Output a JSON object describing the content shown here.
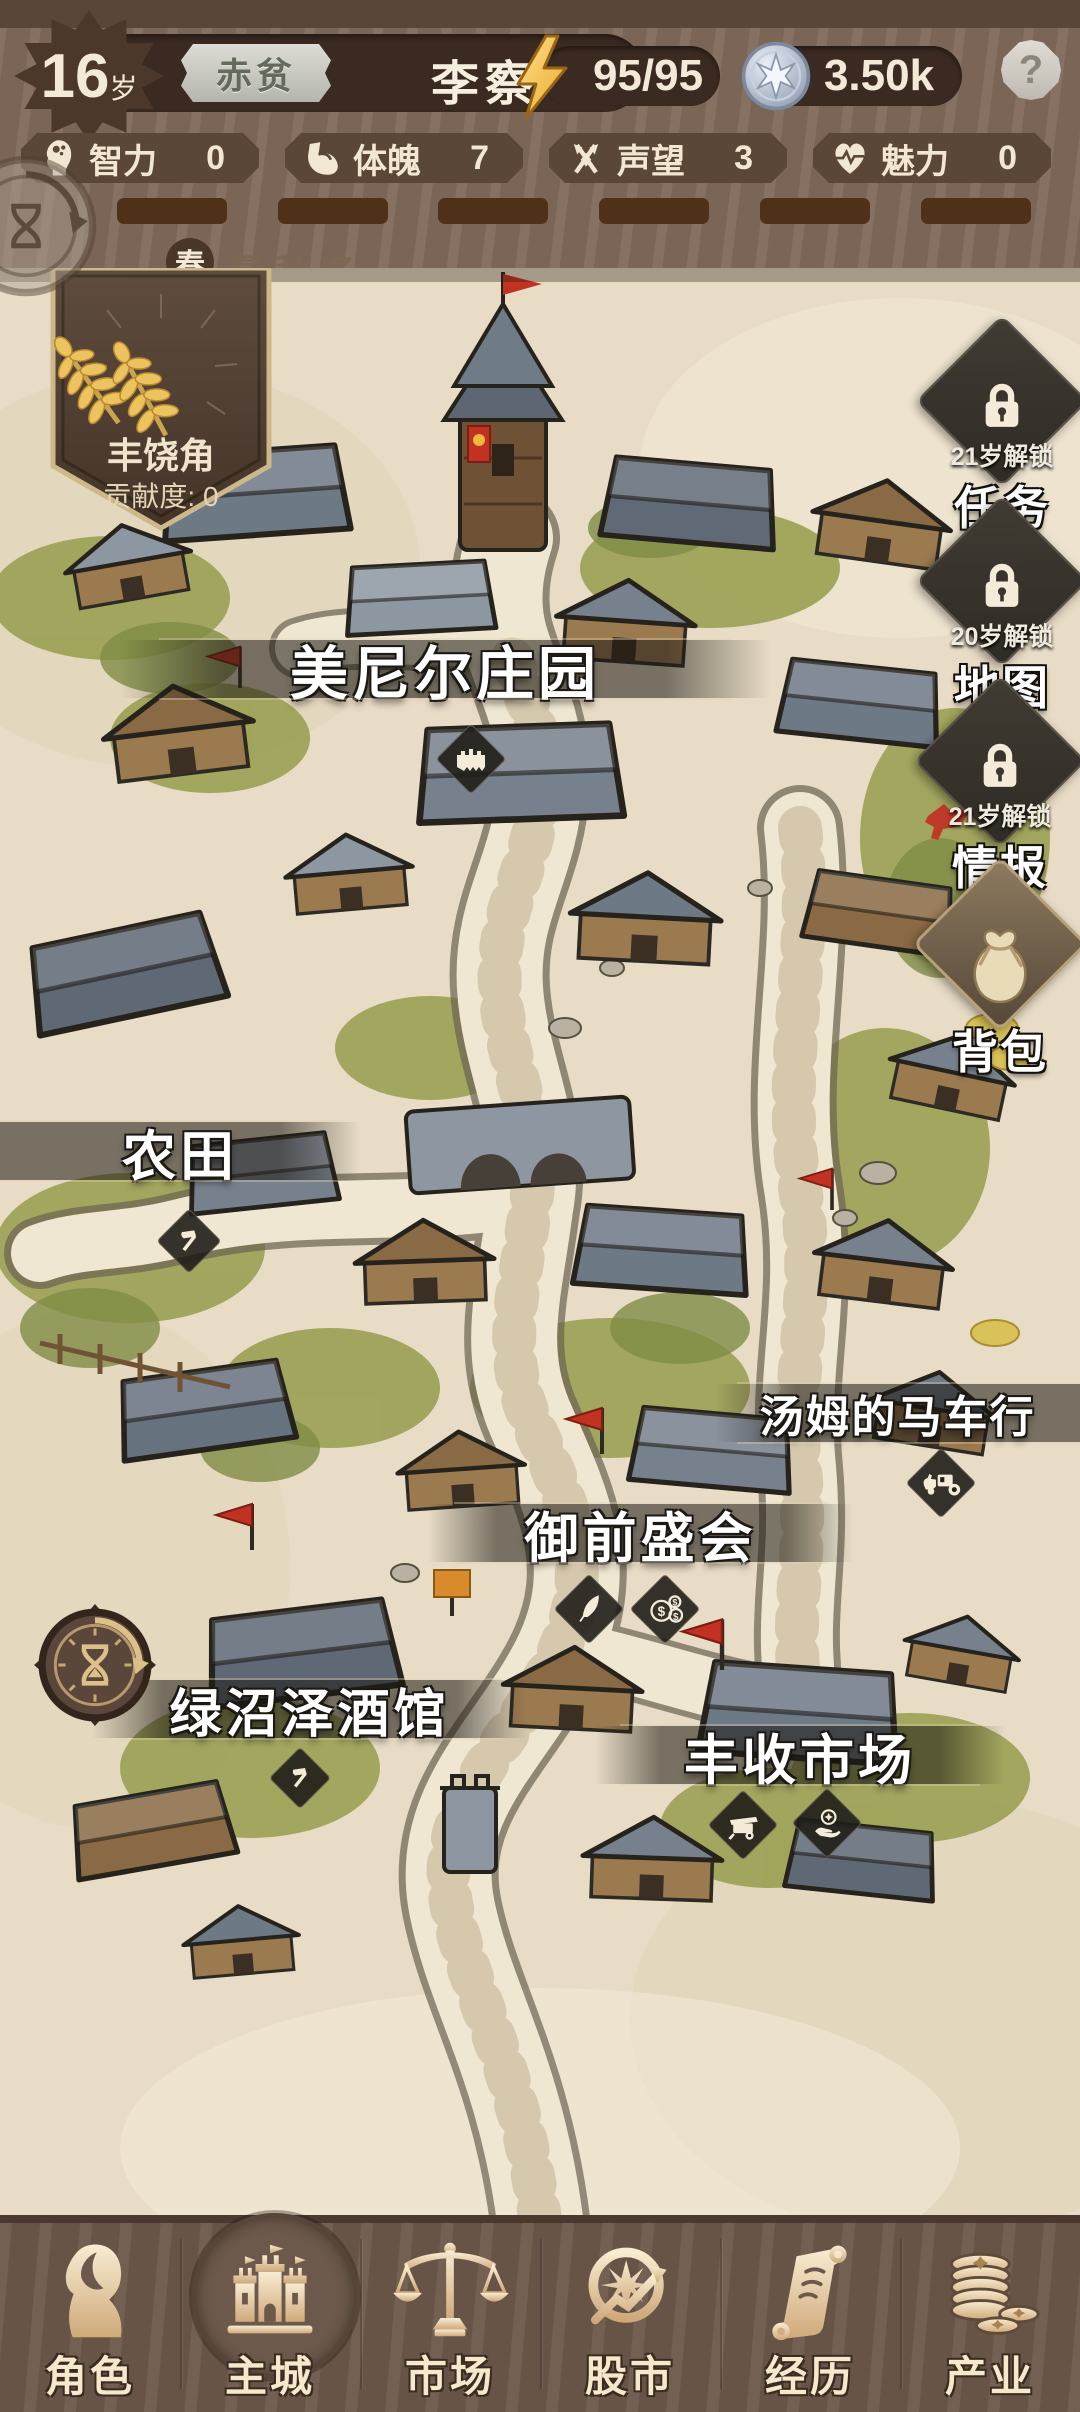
{
  "header": {
    "age": "16",
    "age_suffix": "岁",
    "wealth_badge": "赤贫",
    "player_name": "李察",
    "energy": "95/95",
    "currency": "3.50k",
    "help": "?"
  },
  "stats": [
    {
      "id": "intelligence",
      "label": "智力",
      "value": "0"
    },
    {
      "id": "physique",
      "label": "体魄",
      "value": "7"
    },
    {
      "id": "reputation",
      "label": "声望",
      "value": "3"
    },
    {
      "id": "charm",
      "label": "魅力",
      "value": "0"
    }
  ],
  "season_bar": {
    "segment_count": 6,
    "seasons": [
      {
        "label": "春",
        "active": true
      },
      {
        "label": "夏",
        "active": false
      },
      {
        "label": "秋",
        "active": false
      },
      {
        "label": "冬",
        "active": false
      }
    ]
  },
  "guild_banner": {
    "name": "丰饶角",
    "contribution": "贡献度: 0"
  },
  "side_buttons": [
    {
      "id": "tasks",
      "label": "任务",
      "unlock": "21岁解锁",
      "locked": true
    },
    {
      "id": "map",
      "label": "地图",
      "unlock": "20岁解锁",
      "locked": true
    },
    {
      "id": "intel",
      "label": "情报",
      "unlock": "21岁解锁",
      "locked": true
    },
    {
      "id": "backpack",
      "label": "背包",
      "locked": false
    }
  ],
  "locations": {
    "manor": "美尼尔庄园",
    "farmland": "农田",
    "carriage_shop": "汤姆的马车行",
    "royal_fair": "御前盛会",
    "tavern": "绿沼泽酒馆",
    "harvest_market": "丰收市场"
  },
  "bottom_nav": [
    {
      "id": "character",
      "label": "角色",
      "active": false
    },
    {
      "id": "city",
      "label": "主城",
      "active": true
    },
    {
      "id": "market",
      "label": "市场",
      "active": false
    },
    {
      "id": "stocks",
      "label": "股市",
      "active": false
    },
    {
      "id": "experience",
      "label": "经历",
      "active": false
    },
    {
      "id": "industry",
      "label": "产业",
      "active": false
    }
  ],
  "colors": {
    "wood": "#80695a",
    "dark_plate": "#3a2a21",
    "parchment": "#e8dcc6",
    "cream": "#f3e9d7",
    "gold": "#ecc35f",
    "energy_gold": "#f5c243",
    "coin_silver": "#b9c4d6",
    "flag_red": "#c23222",
    "nav_bg": "#6d594b"
  }
}
